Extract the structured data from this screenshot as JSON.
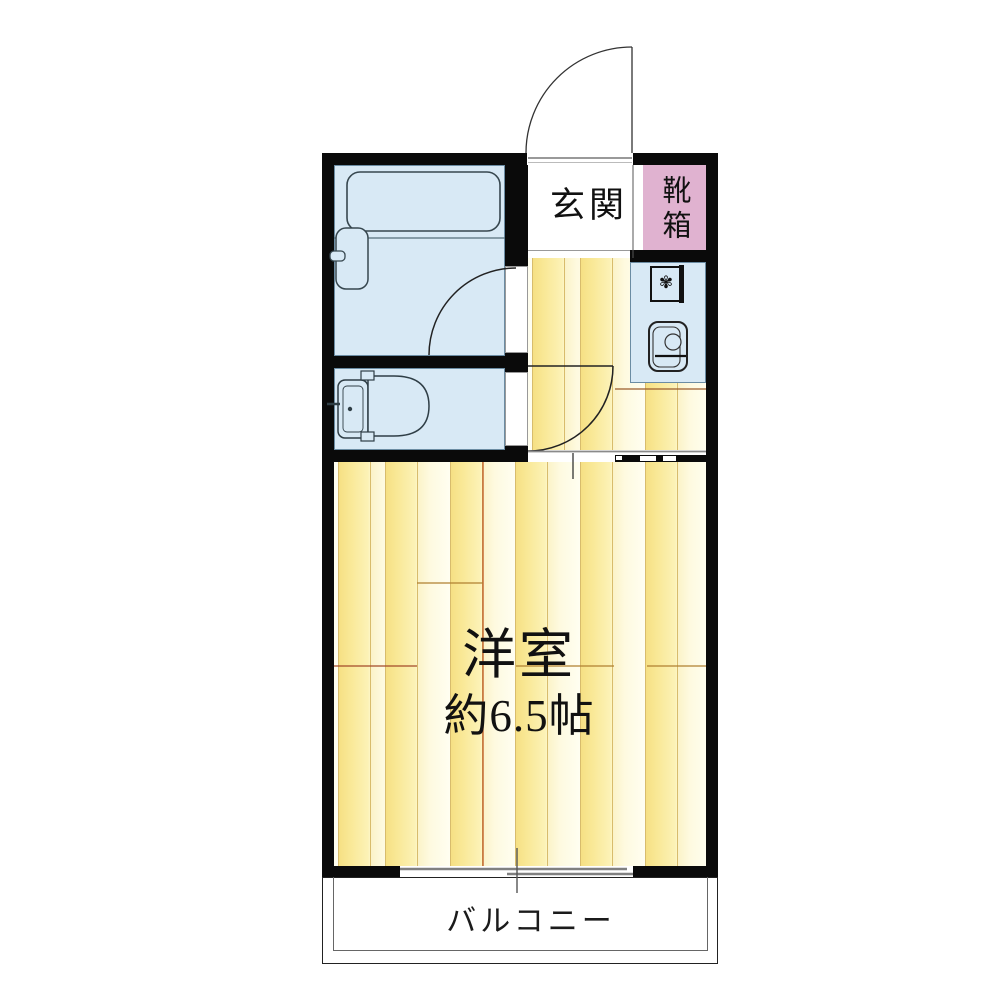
{
  "floor_plan": {
    "type": "apartment-1K-floor-plan",
    "rooms": {
      "genkan": {
        "label": "玄関"
      },
      "shoe_box": {
        "label": "靴箱"
      },
      "bathroom": {
        "fixtures": [
          "bathtub",
          "washbasin"
        ],
        "door": "hinged-swing-in"
      },
      "toilet": {
        "fixtures": [
          "toilet"
        ],
        "door": "flush-panel"
      },
      "kitchen": {
        "fixtures": [
          "single-burner-stove",
          "sink"
        ]
      },
      "main_room": {
        "label": "洋室",
        "size_label": "約6.5帖"
      },
      "balcony": {
        "label": "バルコニー",
        "window": "sliding-double-sash"
      }
    },
    "entrance": {
      "door": "hinged-swing-out"
    },
    "icons": {
      "burner_glyph": "✾"
    },
    "colors": {
      "wall": "#0a0a0a",
      "wet_area_blue": "#d8e9f5",
      "shoe_box_pink": "#e0b2d0",
      "floor_bright_yellow": "#f6e084",
      "floor_pale_cream": "#fffef0",
      "plank_line": "#d8bc6c",
      "joint_brown": "#9a5b2b",
      "accent_orange": "#c2632e"
    }
  }
}
